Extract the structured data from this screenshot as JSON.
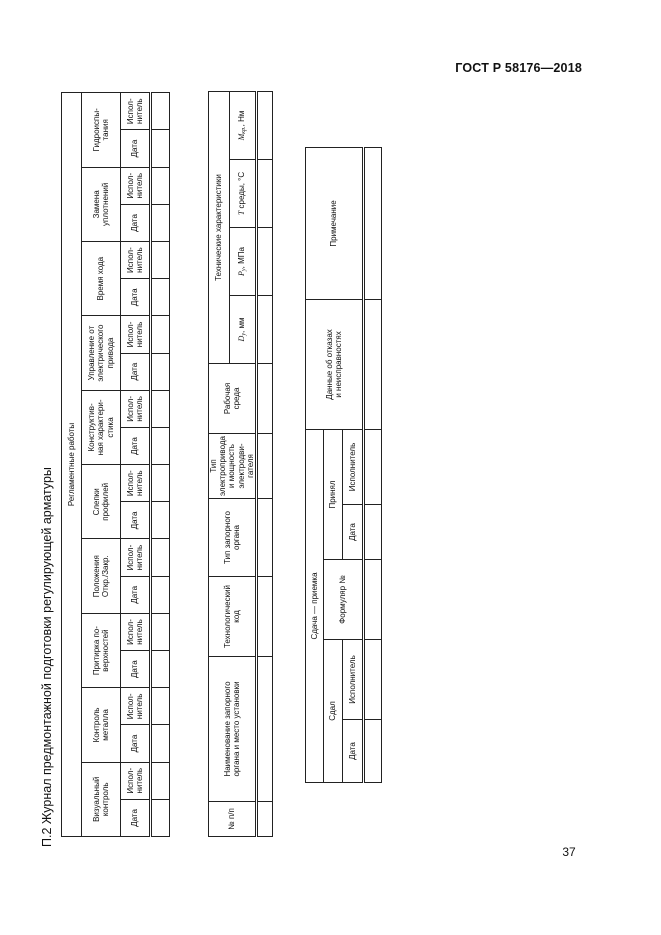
{
  "page": {
    "standard": "ГОСТ Р 58176—2018",
    "number": "37",
    "appendix_title": "П.2 Журнал предмонтажной подготовки регулирующей арматуры"
  },
  "works_table": {
    "title": "Регламентные работы",
    "date_label": "Дата",
    "executor_label": "Испол-\nнитель",
    "groups": [
      "Визуальный\nконтроль",
      "Контроль\nметалла",
      "Притирка по-\nверхностей",
      "Положения\nОткр./Закр.",
      "Слепки\nпрофилей",
      "Конструктив-\nная характери-\nстика",
      "Управление от\nэлектрического\nпривода",
      "Время хода",
      "Замена\nуплотнений",
      "Гидроиспы-\nтания"
    ]
  },
  "valve_table": {
    "columns": [
      "№ п/п",
      "Наименование запорного\nоргана и место установки",
      "Технологический\nкод",
      "Тип запорного\nоргана",
      "Тип электропривода\nи мощность электродви-\nгателя",
      "Рабочая\nсреда"
    ],
    "tech_group": "Технические характеристики",
    "tech_params": [
      {
        "sym": "D",
        "sub": "у",
        "unit": ", мм"
      },
      {
        "sym": "P",
        "sub": "у",
        "unit": ", МПа"
      },
      {
        "sym": "Т",
        "sub": "",
        "unit": " среды, °С"
      },
      {
        "sym": "М",
        "sub": "кр.",
        "unit": ", Нм"
      }
    ]
  },
  "acceptance_table": {
    "handover_group": "Сдача — приемка",
    "delivered": "Сдал",
    "accepted": "Принял",
    "form_no": "Формуляр №",
    "date_label": "Дата",
    "executor_label": "Исполнитель",
    "failures": "Данные об отказах\nи неисправностях",
    "note": "Примечание"
  }
}
